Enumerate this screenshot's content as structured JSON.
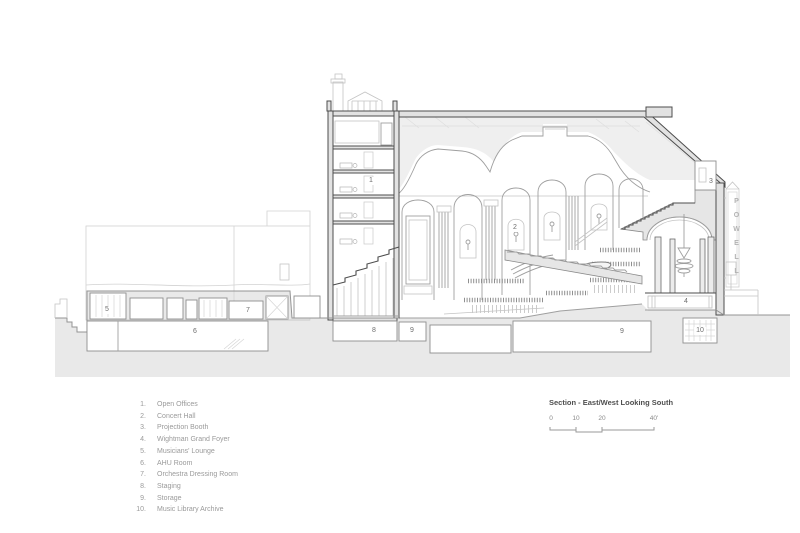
{
  "drawing": {
    "callouts": [
      "1",
      "2",
      "3",
      "4",
      "5",
      "6",
      "7",
      "8",
      "9",
      "9",
      "10"
    ],
    "sign_text": "POWELL"
  },
  "legend": {
    "items": [
      {
        "num": "1.",
        "label": "Open Offices"
      },
      {
        "num": "2.",
        "label": "Concert Hall"
      },
      {
        "num": "3.",
        "label": "Projection Booth"
      },
      {
        "num": "4.",
        "label": "Wightman Grand Foyer"
      },
      {
        "num": "5.",
        "label": "Musicians' Lounge"
      },
      {
        "num": "6.",
        "label": "AHU Room"
      },
      {
        "num": "7.",
        "label": "Orchestra Dressing Room"
      },
      {
        "num": "8.",
        "label": "Staging"
      },
      {
        "num": "9.",
        "label": "Storage"
      },
      {
        "num": "10.",
        "label": "Music Library Archive"
      }
    ]
  },
  "caption": {
    "title": "Section - East/West Looking South",
    "scale_ticks": [
      "0",
      "10",
      "20",
      "40'"
    ]
  }
}
